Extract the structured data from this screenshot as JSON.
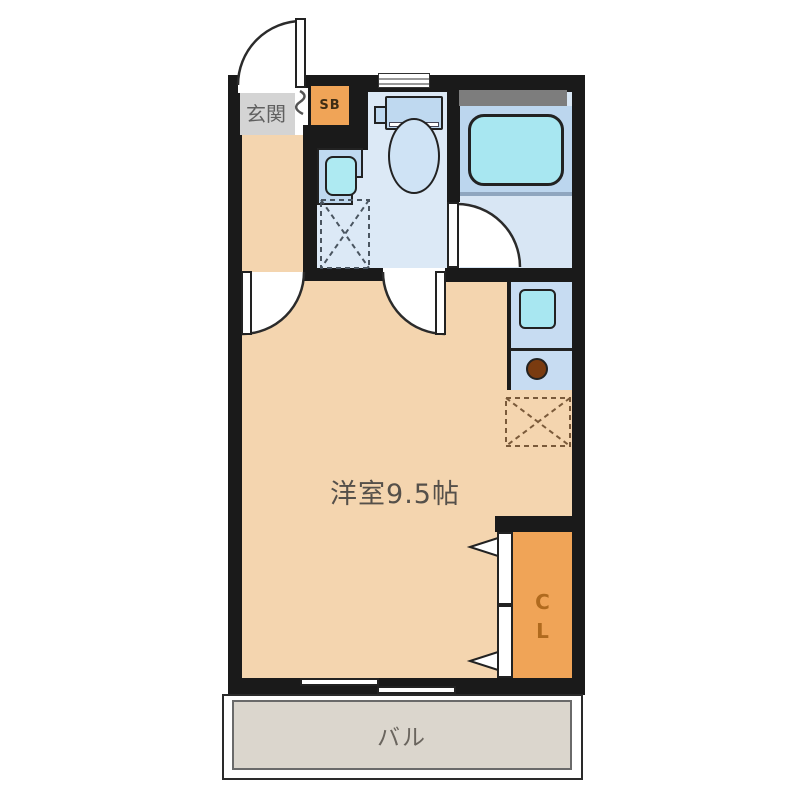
{
  "title": "apartment-floor-plan",
  "rooms": {
    "genkan": {
      "label": "玄関"
    },
    "shoe_box": {
      "label": "SB"
    },
    "main_room": {
      "label": "洋室9.5帖"
    },
    "closet": {
      "label": "CL"
    },
    "balcony": {
      "label": "バル"
    }
  },
  "fixtures": [
    "entrance-door",
    "toilet",
    "hand-sink",
    "washer-space",
    "bathtub",
    "bathroom-door",
    "kitchen-sink",
    "burner",
    "fridge-space",
    "closet-bifold-door",
    "sliding-window",
    "toilet-window",
    "room-doors"
  ],
  "colors": {
    "wall": "#1a1a1a",
    "room_floor": "#f4d5af",
    "genkan_gray": "#d4d4d4",
    "wet_area_floor": "#dce9f6",
    "fixture_blue": "#bfd9f0",
    "basin_cyan": "#a8e7f1",
    "accent_orange": "#f0a457",
    "burner_brown": "#7a3b10",
    "balcony_gray": "#dbd6cd"
  }
}
